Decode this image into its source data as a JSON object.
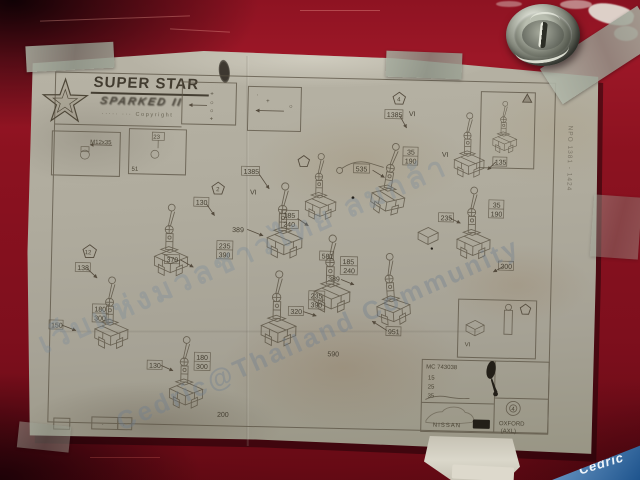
{
  "watermarks": {
    "thai_line": "เว็บแห่งมวลชาวไทย ลมกล้า",
    "latin_line": "Cedric@Thailand Community",
    "corner_logo": "Cedric"
  },
  "sheet": {
    "brand": {
      "title": "SUPER STAR",
      "subtitle": "SPARKED II",
      "tagline": "····· ··· Copyright"
    },
    "legend": {
      "box_a": [
        "+",
        "○",
        "○",
        "+"
      ],
      "box_b": [
        "+",
        "○",
        "·"
      ]
    },
    "detail": {
      "bolt_spec": "M12x35",
      "box_b_top": "23",
      "box_b_corner": "51"
    }
  },
  "diagram": {
    "labels": [
      "1385",
      "VI",
      "185",
      "240",
      "389",
      "130",
      "235",
      "390",
      "370",
      "535",
      "35",
      "190",
      "1385",
      "VI",
      "VI",
      "135",
      "35",
      "190",
      "235",
      "300",
      "185",
      "240",
      "389",
      "235",
      "390",
      "320",
      "951",
      "590",
      "581",
      "138",
      "150",
      "180",
      "300",
      "130",
      "180",
      "300",
      "200",
      "2",
      "4",
      "12",
      "VI"
    ]
  },
  "table": {
    "code": "MC 743038",
    "rows": [
      "15",
      "25",
      "35"
    ],
    "brand_left": "NISSAN",
    "model": "OXFORD",
    "model_variant": "(AXL)",
    "badge": "4"
  },
  "margin": {
    "vertical_code": "NPO 1381 - 1424",
    "cell_marks": [
      "·",
      "·"
    ]
  }
}
